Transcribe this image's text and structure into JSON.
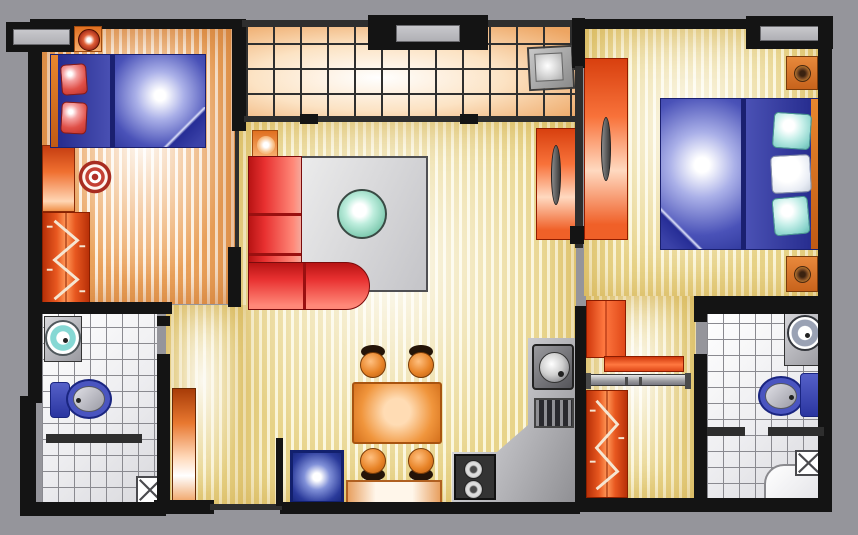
{
  "meta": {
    "type": "floor-plan",
    "description": "Top-down color floor plan of a two-bedroom apartment with living-dining room, open kitchen, tiled balcony, dressing corridor and two bathrooms"
  },
  "palette": {
    "background": "#95959b",
    "wall": "#141414",
    "glass": "#b0b0b5",
    "warm_stripe": "#eba45e",
    "warm_gap": "#fdf2e4",
    "yellow_stripe": "#e8d48a",
    "yellow_gap": "#fbf6da",
    "tile_orange": "#eda562",
    "grout_dark": "#2f2f2f",
    "bath_grout": "#8a8a90",
    "bed_blue": "#3b42a8",
    "headboard_orange": "#d96a2a",
    "pillow_red": "#d43030",
    "pillow_teal": "#9adcd4",
    "sofa_red": "#e02020",
    "rug_gray": "#d4d4d4",
    "table_green": "#7cc9ae",
    "wardrobe_red": "#c03010",
    "counter_gray": "#c8c8c8",
    "toilet_blue": "#4a55c0",
    "mat_blue": "#2a3a9a",
    "dining_orange": "#d4701c",
    "lamp_brown": "#6b3e22"
  },
  "rooms": [
    {
      "id": "bedroom-1",
      "label": "Bedroom top-left"
    },
    {
      "id": "balcony",
      "label": "Tiled balcony strip top-center"
    },
    {
      "id": "living-dining",
      "label": "Living and dining room center"
    },
    {
      "id": "kitchen",
      "label": "Open kitchen bottom-center-right"
    },
    {
      "id": "bedroom-2",
      "label": "Bedroom top-right"
    },
    {
      "id": "dressing-corridor",
      "label": "Closet corridor right"
    },
    {
      "id": "bathroom-1",
      "label": "Bathroom bottom-left"
    },
    {
      "id": "bathroom-2",
      "label": "Bathroom bottom-right"
    },
    {
      "id": "entry",
      "label": "Entry at bottom wall"
    }
  ],
  "furniture": [
    {
      "room": "bedroom-1",
      "items": [
        "double bed with two red pillows",
        "bedside lamp",
        "round rug",
        "dresser",
        "zigzag hanging wardrobe"
      ]
    },
    {
      "room": "balcony",
      "items": [
        "window",
        "small appliance",
        "sliding door line"
      ]
    },
    {
      "room": "living-dining",
      "items": [
        "red corner sofa",
        "green round coffee table",
        "gray area rug",
        "floor lamp",
        "tv cabinet panel",
        "dining table",
        "four orange chairs",
        "sideboard",
        "blue doormat",
        "entry door leaf"
      ]
    },
    {
      "room": "kitchen",
      "items": [
        "L-shaped counter",
        "round sink",
        "dish rack",
        "two-burner stove"
      ]
    },
    {
      "room": "bedroom-2",
      "items": [
        "double bed with teal and white pillows",
        "two lamp nightstands",
        "red wardrobe panel",
        "window"
      ]
    },
    {
      "room": "dressing-corridor",
      "items": [
        "red cabinet",
        "shelf",
        "clothes rail",
        "zigzag hanging wardrobe"
      ]
    },
    {
      "room": "bathroom-1",
      "items": [
        "teal round washbasin",
        "blue toilet",
        "shower tile with X"
      ]
    },
    {
      "room": "bathroom-2",
      "items": [
        "round washbasin",
        "blue toilet",
        "corner shower tray",
        "tile with X"
      ]
    }
  ],
  "windows": [
    {
      "id": "window-top-left"
    },
    {
      "id": "window-top-center"
    },
    {
      "id": "window-top-right"
    }
  ]
}
